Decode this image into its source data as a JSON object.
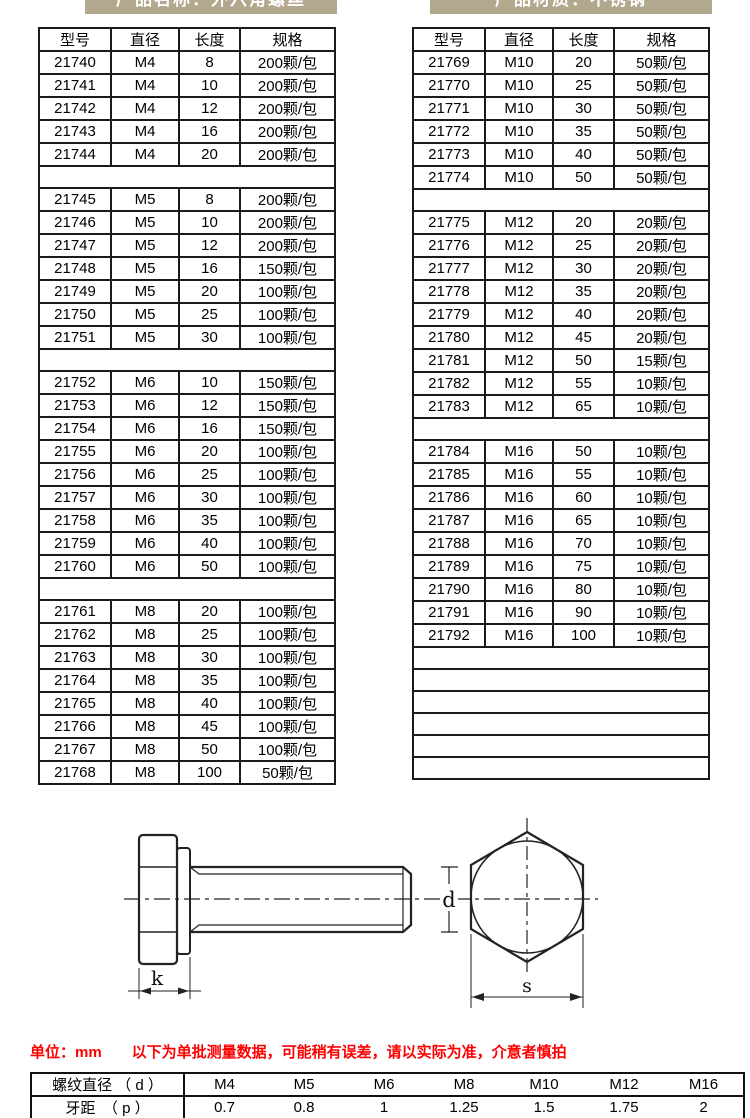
{
  "banners": {
    "left": "产品名称：外六角螺丝",
    "right": "产品材质：不锈钢"
  },
  "spec_tables": {
    "headers": [
      "型号",
      "直径",
      "长度",
      "规格"
    ],
    "left_rows": [
      [
        "21740",
        "M4",
        "8",
        "200颗/包"
      ],
      [
        "21741",
        "M4",
        "10",
        "200颗/包"
      ],
      [
        "21742",
        "M4",
        "12",
        "200颗/包"
      ],
      [
        "21743",
        "M4",
        "16",
        "200颗/包"
      ],
      [
        "21744",
        "M4",
        "20",
        "200颗/包"
      ],
      [],
      [
        "21745",
        "M5",
        "8",
        "200颗/包"
      ],
      [
        "21746",
        "M5",
        "10",
        "200颗/包"
      ],
      [
        "21747",
        "M5",
        "12",
        "200颗/包"
      ],
      [
        "21748",
        "M5",
        "16",
        "150颗/包"
      ],
      [
        "21749",
        "M5",
        "20",
        "100颗/包"
      ],
      [
        "21750",
        "M5",
        "25",
        "100颗/包"
      ],
      [
        "21751",
        "M5",
        "30",
        "100颗/包"
      ],
      [],
      [
        "21752",
        "M6",
        "10",
        "150颗/包"
      ],
      [
        "21753",
        "M6",
        "12",
        "150颗/包"
      ],
      [
        "21754",
        "M6",
        "16",
        "150颗/包"
      ],
      [
        "21755",
        "M6",
        "20",
        "100颗/包"
      ],
      [
        "21756",
        "M6",
        "25",
        "100颗/包"
      ],
      [
        "21757",
        "M6",
        "30",
        "100颗/包"
      ],
      [
        "21758",
        "M6",
        "35",
        "100颗/包"
      ],
      [
        "21759",
        "M6",
        "40",
        "100颗/包"
      ],
      [
        "21760",
        "M6",
        "50",
        "100颗/包"
      ],
      [],
      [
        "21761",
        "M8",
        "20",
        "100颗/包"
      ],
      [
        "21762",
        "M8",
        "25",
        "100颗/包"
      ],
      [
        "21763",
        "M8",
        "30",
        "100颗/包"
      ],
      [
        "21764",
        "M8",
        "35",
        "100颗/包"
      ],
      [
        "21765",
        "M8",
        "40",
        "100颗/包"
      ],
      [
        "21766",
        "M8",
        "45",
        "100颗/包"
      ],
      [
        "21767",
        "M8",
        "50",
        "100颗/包"
      ],
      [
        "21768",
        "M8",
        "100",
        "50颗/包"
      ]
    ],
    "right_rows": [
      [
        "21769",
        "M10",
        "20",
        "50颗/包"
      ],
      [
        "21770",
        "M10",
        "25",
        "50颗/包"
      ],
      [
        "21771",
        "M10",
        "30",
        "50颗/包"
      ],
      [
        "21772",
        "M10",
        "35",
        "50颗/包"
      ],
      [
        "21773",
        "M10",
        "40",
        "50颗/包"
      ],
      [
        "21774",
        "M10",
        "50",
        "50颗/包"
      ],
      [],
      [
        "21775",
        "M12",
        "20",
        "20颗/包"
      ],
      [
        "21776",
        "M12",
        "25",
        "20颗/包"
      ],
      [
        "21777",
        "M12",
        "30",
        "20颗/包"
      ],
      [
        "21778",
        "M12",
        "35",
        "20颗/包"
      ],
      [
        "21779",
        "M12",
        "40",
        "20颗/包"
      ],
      [
        "21780",
        "M12",
        "45",
        "20颗/包"
      ],
      [
        "21781",
        "M12",
        "50",
        "15颗/包"
      ],
      [
        "21782",
        "M12",
        "55",
        "10颗/包"
      ],
      [
        "21783",
        "M12",
        "65",
        "10颗/包"
      ],
      [],
      [
        "21784",
        "M16",
        "50",
        "10颗/包"
      ],
      [
        "21785",
        "M16",
        "55",
        "10颗/包"
      ],
      [
        "21786",
        "M16",
        "60",
        "10颗/包"
      ],
      [
        "21787",
        "M16",
        "65",
        "10颗/包"
      ],
      [
        "21788",
        "M16",
        "70",
        "10颗/包"
      ],
      [
        "21789",
        "M16",
        "75",
        "10颗/包"
      ],
      [
        "21790",
        "M16",
        "80",
        "10颗/包"
      ],
      [
        "21791",
        "M16",
        "90",
        "10颗/包"
      ],
      [
        "21792",
        "M16",
        "100",
        "10颗/包"
      ],
      [],
      [],
      [],
      [],
      [],
      []
    ]
  },
  "diagram": {
    "labels": {
      "k": "k",
      "d": "d",
      "s": "s"
    }
  },
  "footer": {
    "note": "单位：mm　　以下为单批测量数据，可能稍有误差，请以实际为准，介意者慎拍",
    "pitch_table": {
      "diameter_label": "螺纹直径 （ d ）",
      "pitch_label": "牙距　（ p ）",
      "sizes": [
        "M4",
        "M5",
        "M6",
        "M8",
        "M10",
        "M12",
        "M16"
      ],
      "pitches": [
        "0.7",
        "0.8",
        "1",
        "1.25",
        "1.5",
        "1.75",
        "2"
      ]
    }
  },
  "colors": {
    "banner_bg": "#b2a88d",
    "note_red": "#fe0000",
    "line": "#222222"
  }
}
